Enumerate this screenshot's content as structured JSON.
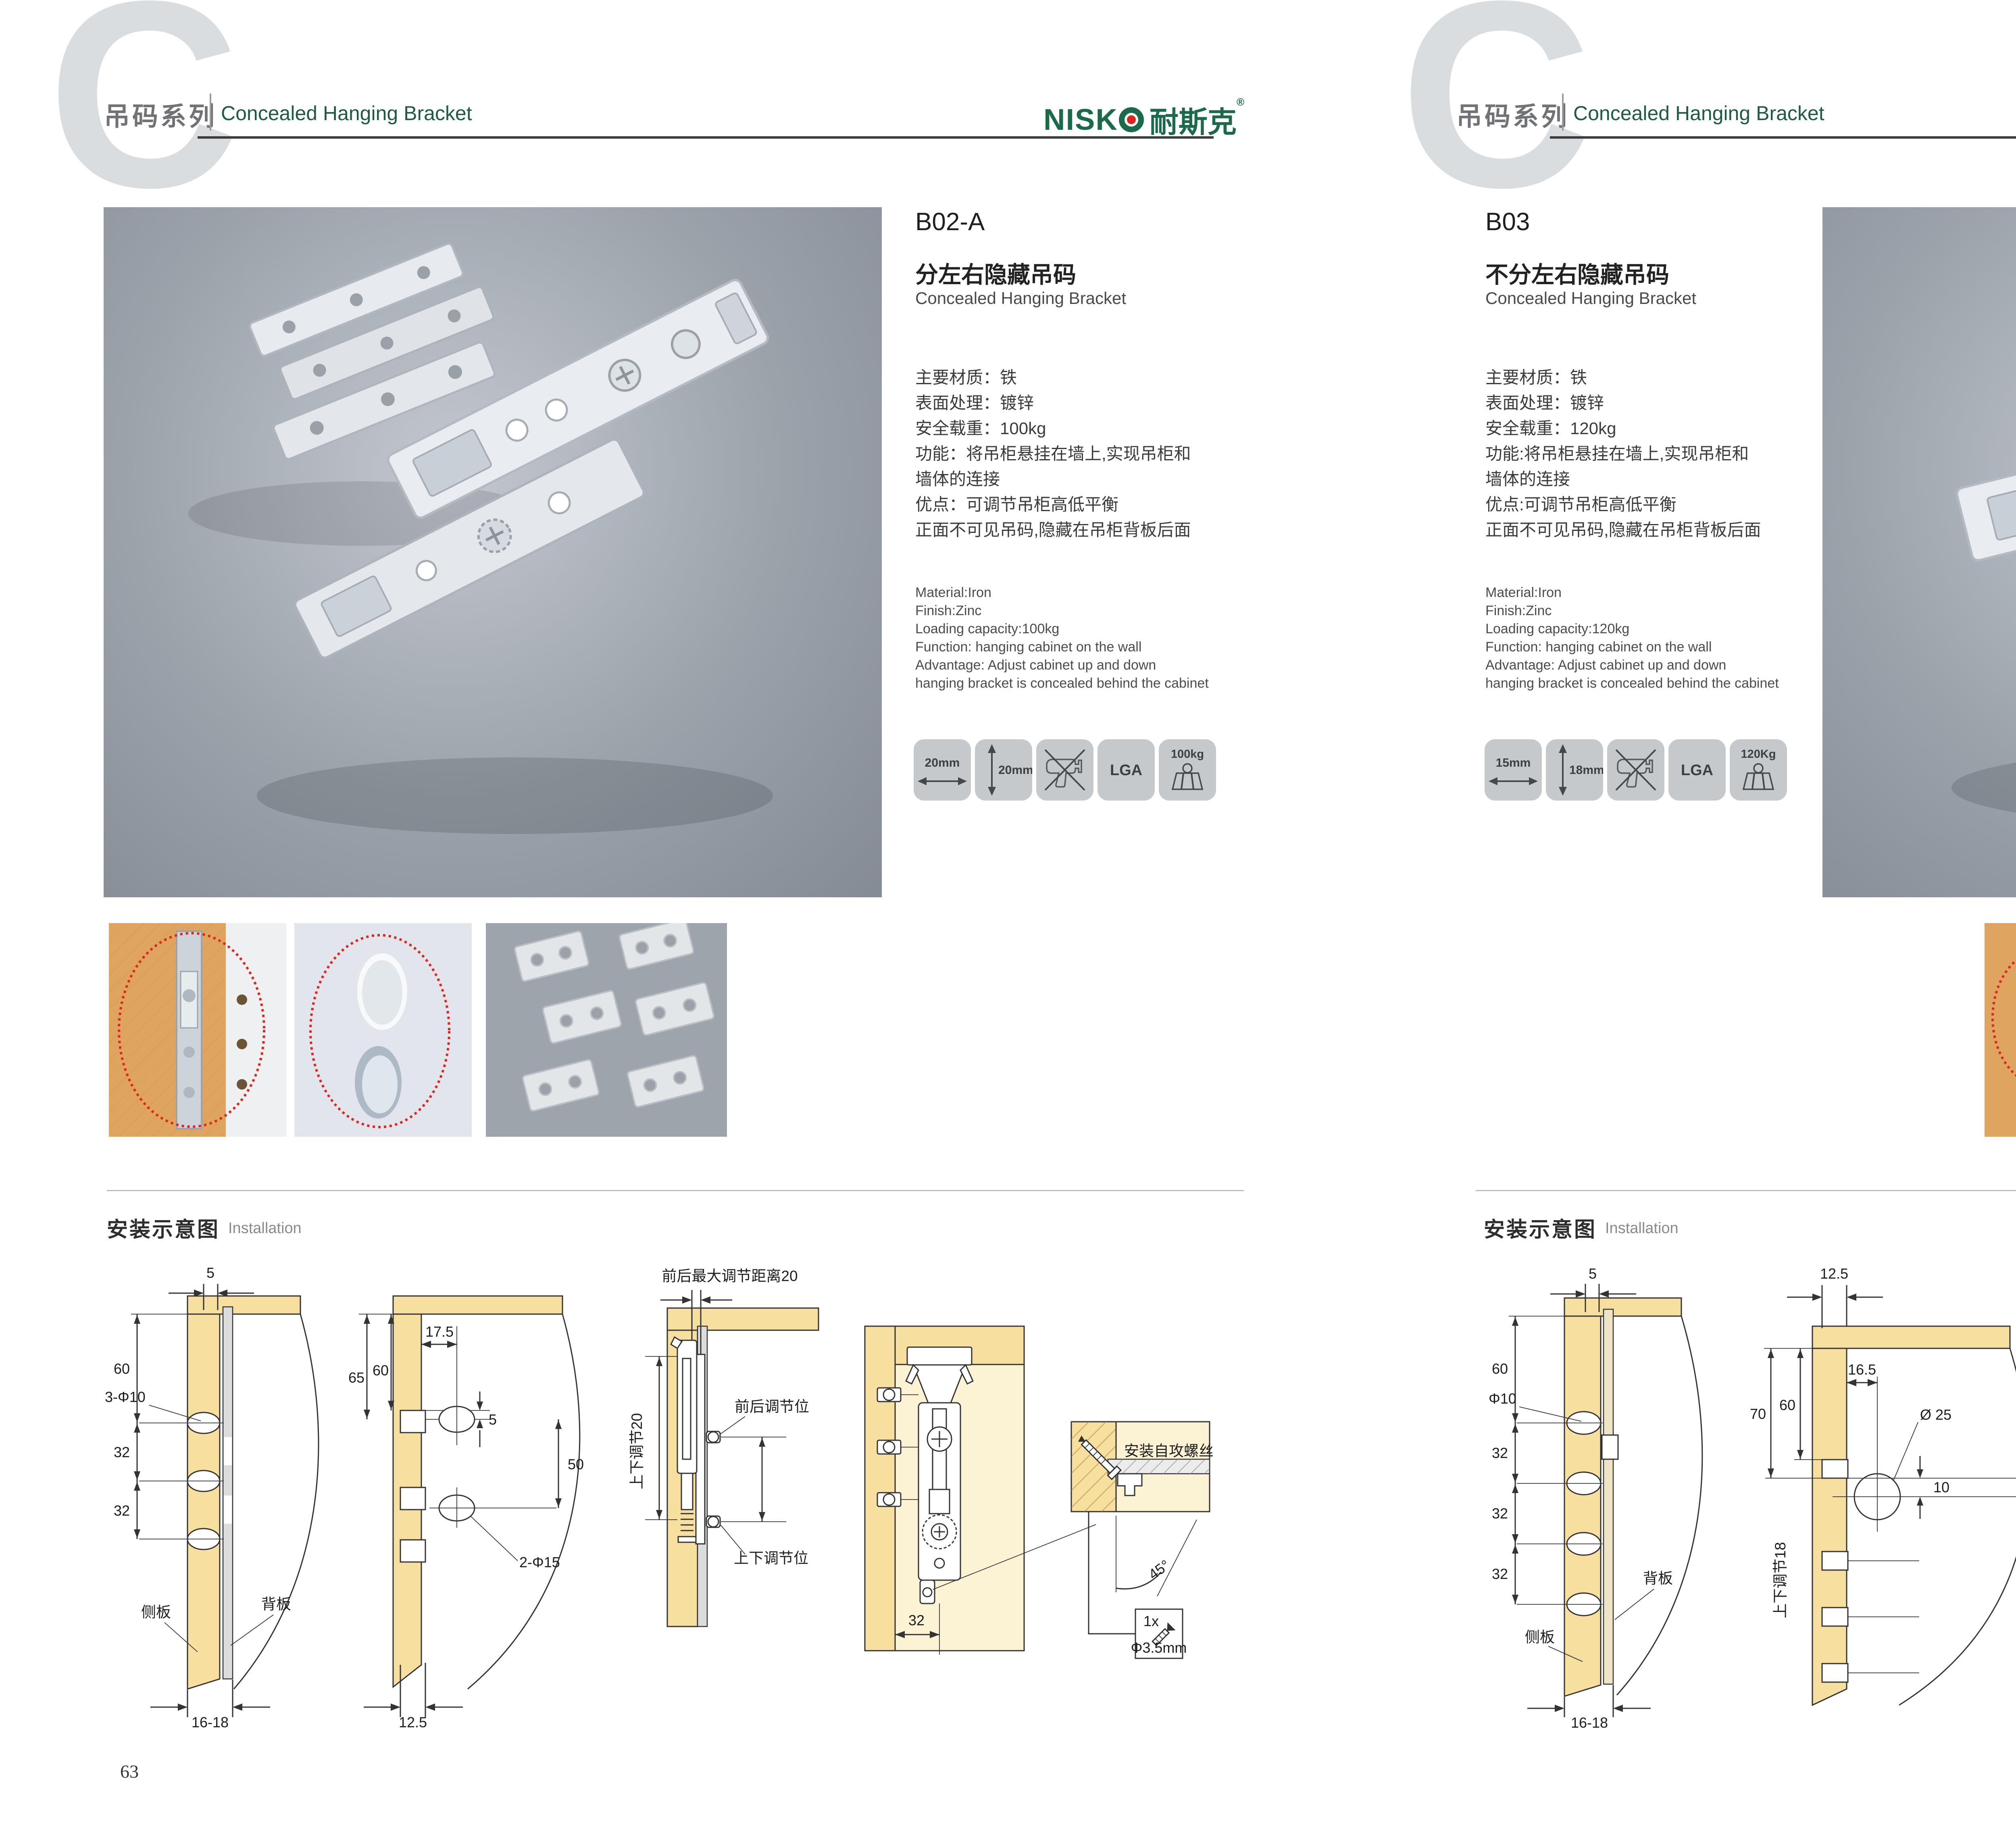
{
  "colors": {
    "brand_green": "#1b6b4a",
    "header_green": "#1d5c40",
    "header_gray": "#717276",
    "accent_red": "#d9261c",
    "wood_yellow": "#f6df9f",
    "wood_light": "#fcf2d4",
    "tile_gray": "#c6c9cb",
    "photo_gray": "#8e949c",
    "line_dark": "#3c3c3c"
  },
  "header": {
    "watermark": "C",
    "series_cn": "吊码系列",
    "series_en": "Concealed Hanging Bracket"
  },
  "brand": {
    "latin_part": "NISK",
    "cn": "耐斯克",
    "registered": "®"
  },
  "pages": [
    {
      "page_number": "63",
      "code": "B02-A",
      "name_cn": "分左右隐藏吊码",
      "name_en": "Concealed Hanging Bracket",
      "specs_cn": [
        "主要材质：铁",
        "表面处理：镀锌",
        "安全载重：100kg",
        "功能：将吊柜悬挂在墙上,实现吊柜和",
        "墙体的连接",
        "优点：可调节吊柜高低平衡",
        "正面不可见吊码,隐藏在吊柜背板后面"
      ],
      "specs_en": [
        "Material:Iron",
        "Finish:Zinc",
        "Loading capacity:100kg",
        "Function: hanging cabinet on the wall",
        "Advantage: Adjust cabinet up and down",
        "hanging bracket is concealed behind the cabinet"
      ],
      "tiles": {
        "t1": "20mm",
        "t2": "20mm",
        "t4": "LGA",
        "t5": "100kg"
      },
      "install_cn": "安装示意图",
      "install_en": "Installation",
      "d1": {
        "top": "5",
        "h60": "60",
        "holes": "3-Φ10",
        "a32": "32",
        "b32": "32",
        "side": "侧板",
        "back": "背板",
        "bottom": "16-18"
      },
      "d2": {
        "h65": "65",
        "h60": "60",
        "w17_5": "17.5",
        "off5": "5",
        "h50": "50",
        "holes": "2-Φ15",
        "bottom": "12.5"
      },
      "d3": {
        "top": "前后最大调节距离20",
        "left": "上下调节20",
        "fb": "前后调节位",
        "ud": "上下调节位"
      },
      "d4": {
        "w32": "32",
        "screw": "安装自攻螺丝",
        "angle": "45°",
        "qty": "1x",
        "dia": "Φ3.5mm"
      }
    },
    {
      "page_number": "64",
      "code": "B03",
      "name_cn": "不分左右隐藏吊码",
      "name_en": "Concealed Hanging Bracket",
      "specs_cn": [
        "主要材质：铁",
        "表面处理：镀锌",
        "安全载重：120kg",
        "功能:将吊柜悬挂在墙上,实现吊柜和",
        "墙体的连接",
        "优点:可调节吊柜高低平衡",
        "正面不可见吊码,隐藏在吊柜背板后面"
      ],
      "specs_en": [
        "Material:Iron",
        "Finish:Zinc",
        "Loading capacity:120kg",
        "Function: hanging cabinet on the wall",
        "Advantage: Adjust cabinet up and down",
        "hanging bracket is concealed behind the cabinet"
      ],
      "tiles": {
        "t1": "15mm",
        "t2": "18mm",
        "t4": "LGA",
        "t5": "120Kg"
      },
      "install_cn": "安装示意图",
      "install_en": "Installation",
      "d1": {
        "top": "5",
        "h60": "60",
        "holes": "Φ10",
        "a32": "32",
        "b32": "32",
        "c32": "32",
        "side": "侧板",
        "back": "背板",
        "bottom": "16-18"
      },
      "d2": {
        "top": "12.5",
        "h70": "70",
        "h60": "60",
        "w16_5": "16.5",
        "dia": "Ø 25",
        "off10": "10",
        "left": "上下调节18"
      },
      "d3": {
        "top": "16.5",
        "left12": "12.5",
        "off10": "10",
        "dia": "∅25",
        "lock": "锁紧状态"
      },
      "d4": {
        "screw": "安装自攻螺丝",
        "angle": "45°",
        "qty": "1x",
        "dia": "Φ3.5mm"
      }
    }
  ]
}
